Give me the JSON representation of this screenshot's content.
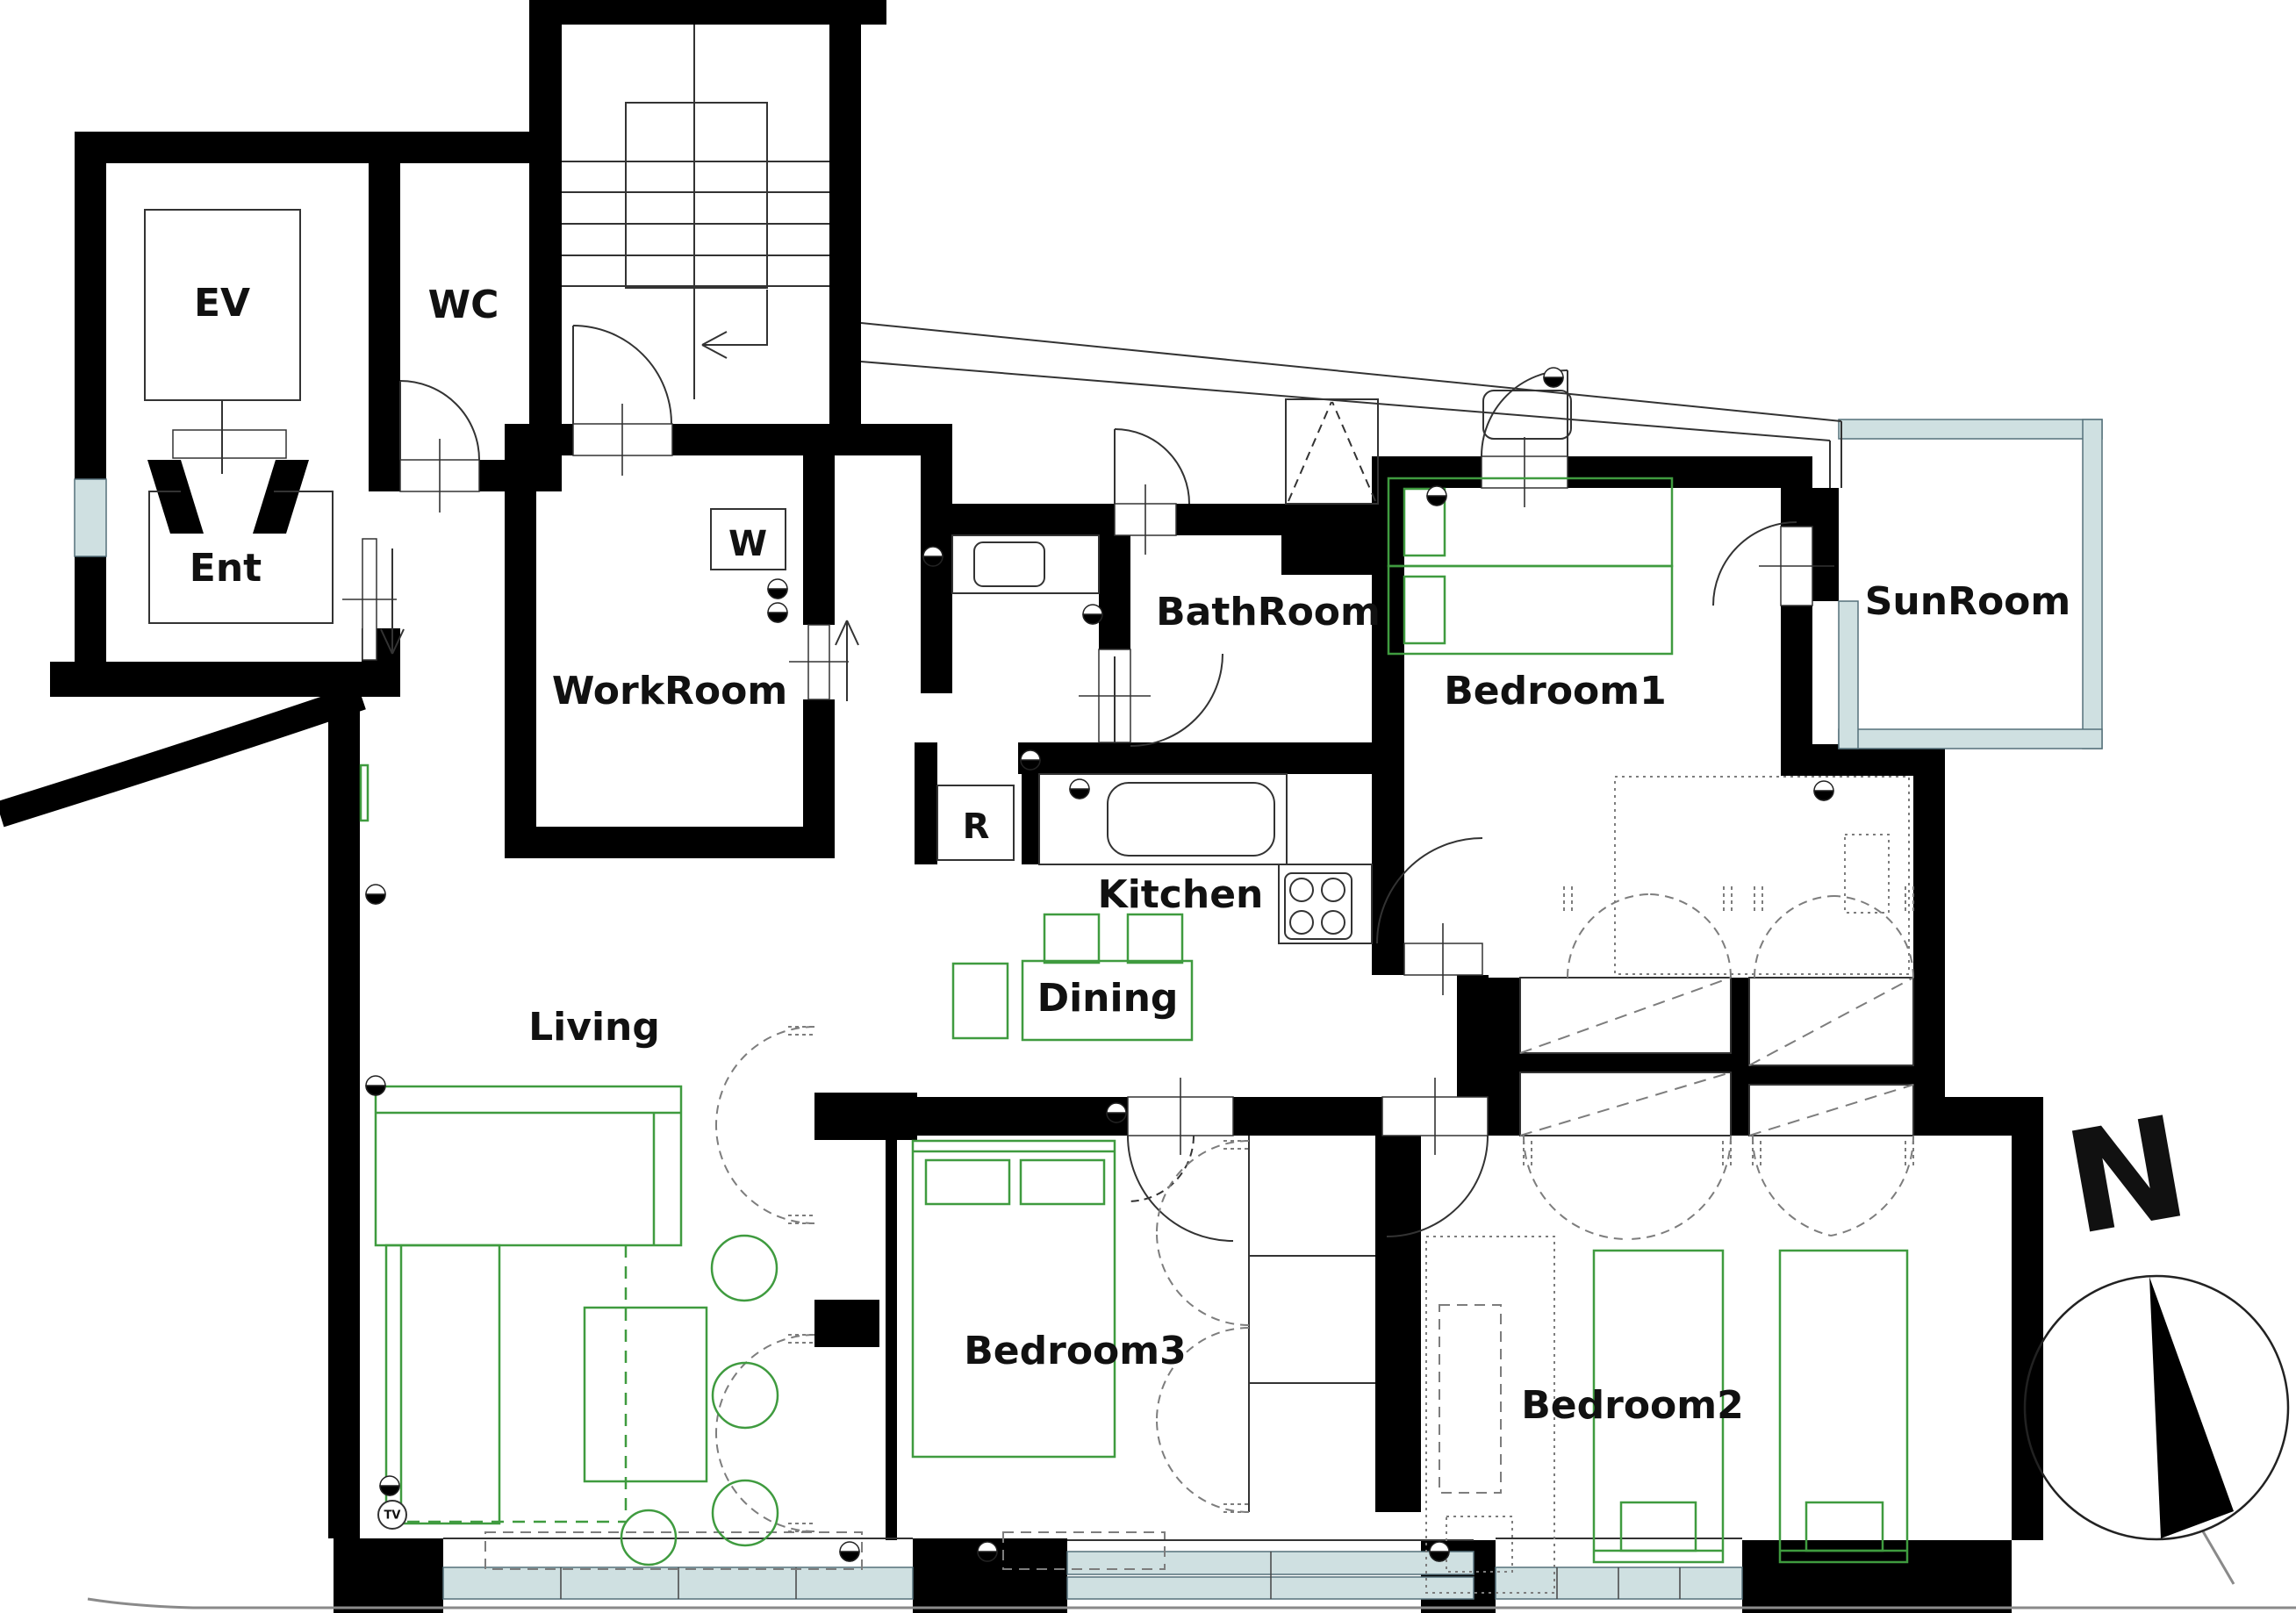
{
  "title": "apartment-floor-plan",
  "labels": {
    "ev": "EV",
    "wc": "WC",
    "ent": "Ent",
    "workroom": "WorkRoom",
    "bathroom": "BathRoom",
    "bedroom1": "Bedroom1",
    "sunroom": "SunRoom",
    "kitchen": "Kitchen",
    "dining": "Dining",
    "living": "Living",
    "bedroom3": "Bedroom3",
    "bedroom2": "Bedroom2",
    "washer": "W",
    "refrigerator": "R",
    "tv": "TV",
    "compass_north": "N"
  },
  "colors": {
    "wall": "#000000",
    "line": "#333333",
    "furniture_green": "#3f9b3f",
    "glass_teal": "#cfe0e1",
    "dash_gray": "#7d7d7d",
    "ground": "#8a8a8a"
  }
}
